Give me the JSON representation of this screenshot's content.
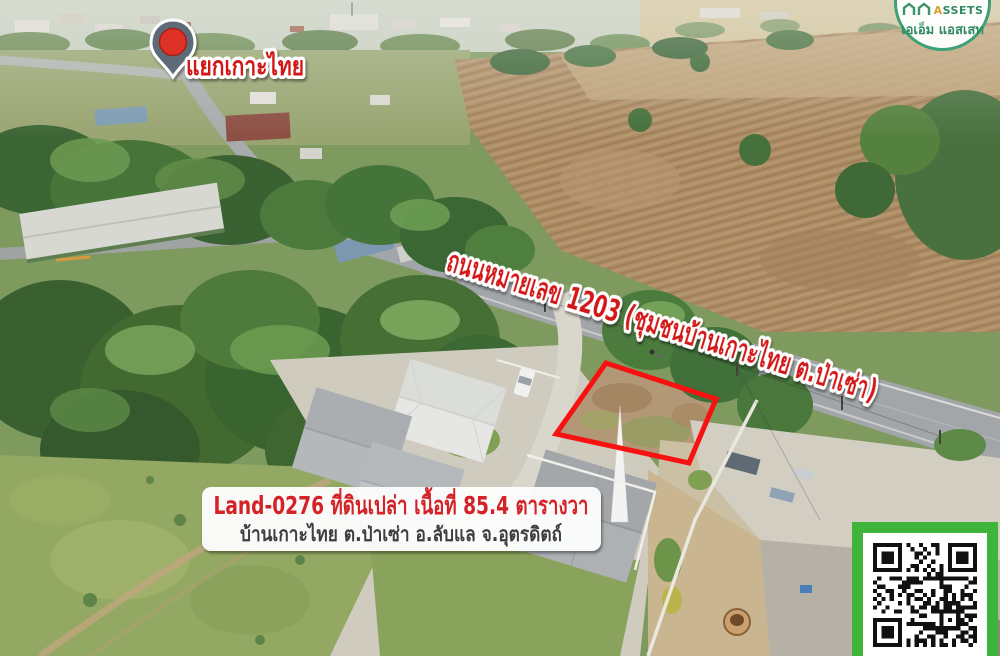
{
  "post": {
    "pin_label": "แยกเกาะไทย",
    "road_label": "ถนนหมายเลข 1203 (ชุมชนบ้านเกาะไทย ต.ป่าเซ่า)",
    "info": {
      "line1": "Land-0276 ที่ดินเปล่า เนื้อที่ 85.4 ตารางวา",
      "line2": "บ้านเกาะไทย ต.ป่าเซ่า อ.ลับแล จ.อุตรดิตถ์"
    },
    "logo": {
      "name": "ASSETS",
      "name_thai": "เอเอ็ม แอสเสท"
    },
    "colors": {
      "overlay_red": "#d31414",
      "outline_red": "#f81111",
      "info_red": "#d42025",
      "info_dark": "#3f3e3e",
      "qr_green": "#3eb43a",
      "logo_green": "#2f8a63",
      "logo_accent": "#d9a02c",
      "pin_body": "#5d6b77",
      "pin_dot": "#df3126"
    }
  }
}
